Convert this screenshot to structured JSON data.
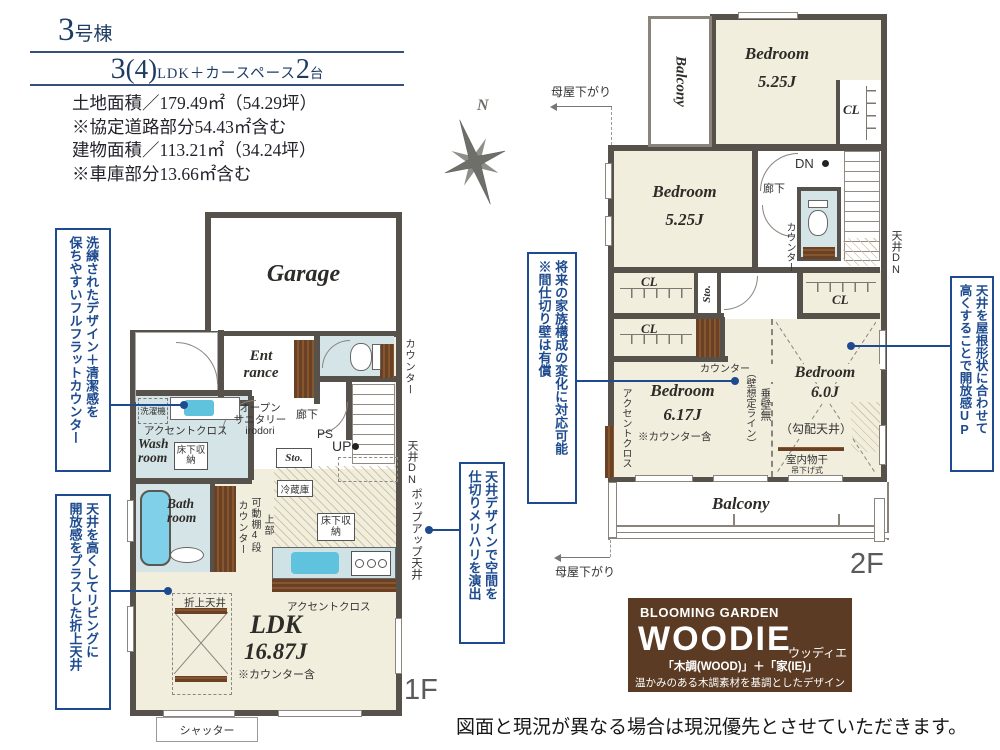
{
  "header": {
    "building_no": "3",
    "building_suffix": "号棟",
    "plan": {
      "rooms_num": "3",
      "rooms_paren": "(4)",
      "rooms_unit": "LDK＋カースペース",
      "cars_num": "2",
      "cars_unit": "台"
    },
    "area_lines": [
      "土地面積／179.49㎡（54.29坪）",
      "※協定道路部分54.43㎡含む",
      "建物面積／113.21㎡（34.24坪）",
      "※車庫部分13.66㎡含む"
    ]
  },
  "compass": {
    "north": "N"
  },
  "callouts": {
    "full_flat_counter": {
      "col1": "洗練されたデザイン＋清潔感を",
      "col2": "保ちやすいフルフラットカウンター"
    },
    "folded_ceiling": {
      "col1": "天井を高くしてリビングに",
      "col2": "開放感をプラスした折上天井"
    },
    "partition": {
      "col1": "将来の家族構成の変化に対応可能",
      "col2": "※間仕切り壁は有償"
    },
    "ceiling_design": {
      "col1": "天井デザインで空間を",
      "col2": "仕切りメリハリを演出"
    },
    "roof_ceiling": {
      "col1": "天井を屋根形状に合わせて",
      "col2": "高くすることで開放感UP"
    }
  },
  "floor1": {
    "floor_label": "1F",
    "garage": "Garage",
    "entrance_l1": "Ent",
    "entrance_l2": "rance",
    "open_sanitary_l1": "オープン",
    "open_sanitary_l2": "サニタリー",
    "open_sanitary_l3": "irodori",
    "hallway": "廊下",
    "ps": "PS",
    "up": "UP",
    "sto": "Sto.",
    "counter_toilet": "カウンター",
    "washer": "洗濯機",
    "accent_cloth_wash": "アクセントクロス",
    "wash_room_l1": "Wash",
    "wash_room_l2": "room",
    "underfloor_wash": "床下収納",
    "bath_room_l1": "Bath",
    "bath_room_l2": "room",
    "shelf_upper": "上部",
    "shelf_movable": "可動棚4段",
    "shelf_counter": "カウンター",
    "fridge": "冷蔵庫",
    "underfloor_kitchen": "床下収納",
    "accent_cloth_kitchen": "アクセントクロス",
    "ceiling_dn": "天井DN",
    "popup_ceiling": "ポップアップ天井",
    "oriage_ceiling": "折上天井",
    "ldk": "LDK",
    "ldk_size": "16.87J",
    "ldk_note": "※カウンター含",
    "shutter": "シャッター"
  },
  "floor2": {
    "floor_label": "2F",
    "moya_top": "母屋下がり",
    "moya_bottom": "母屋下がり",
    "balcony_top": "Balcony",
    "balcony_bottom": "Balcony",
    "bedroom_a_name": "Bedroom",
    "bedroom_a_size": "5.25J",
    "bedroom_b_name": "Bedroom",
    "bedroom_b_size": "5.25J",
    "bedroom_c_name": "Bedroom",
    "bedroom_c_size": "6.17J",
    "bedroom_c_note": "※カウンター含",
    "bedroom_d_name": "Bedroom",
    "bedroom_d_size": "6.0J",
    "bedroom_d_note": "（勾配天井）",
    "cl": "CL",
    "dn": "DN",
    "hallway": "廊下",
    "counter_toilet": "カウンター",
    "ceiling_dn": "天井DN",
    "sto": "Sto.",
    "counter_shelf": "カウンター",
    "accent_cloth": "アクセントクロス",
    "no_wall": "垂壁無",
    "wall_line": "（壁想定ライン）",
    "drying": "室内物干",
    "drying_note": "吊下げ式"
  },
  "logo": {
    "brand": "BLOOMING GARDEN",
    "name": "WOODIE",
    "kana": "ウッディエ",
    "formula": "「木調(WOOD)」＋「家(IE)」",
    "tagline": "温かみのある木調素材を基調としたデザイン"
  },
  "disclaimer": "図面と現況が異なる場合は現況優先とさせていただきます。",
  "colors": {
    "callout_blue": "#1e4b8f",
    "wall": "#57514b",
    "floor_cream": "#f2eedd",
    "water_blue": "#d5e4e7",
    "wood_brown": "#6b4226",
    "logo_brown": "#5b3b24",
    "navy": "#1d3c63"
  }
}
